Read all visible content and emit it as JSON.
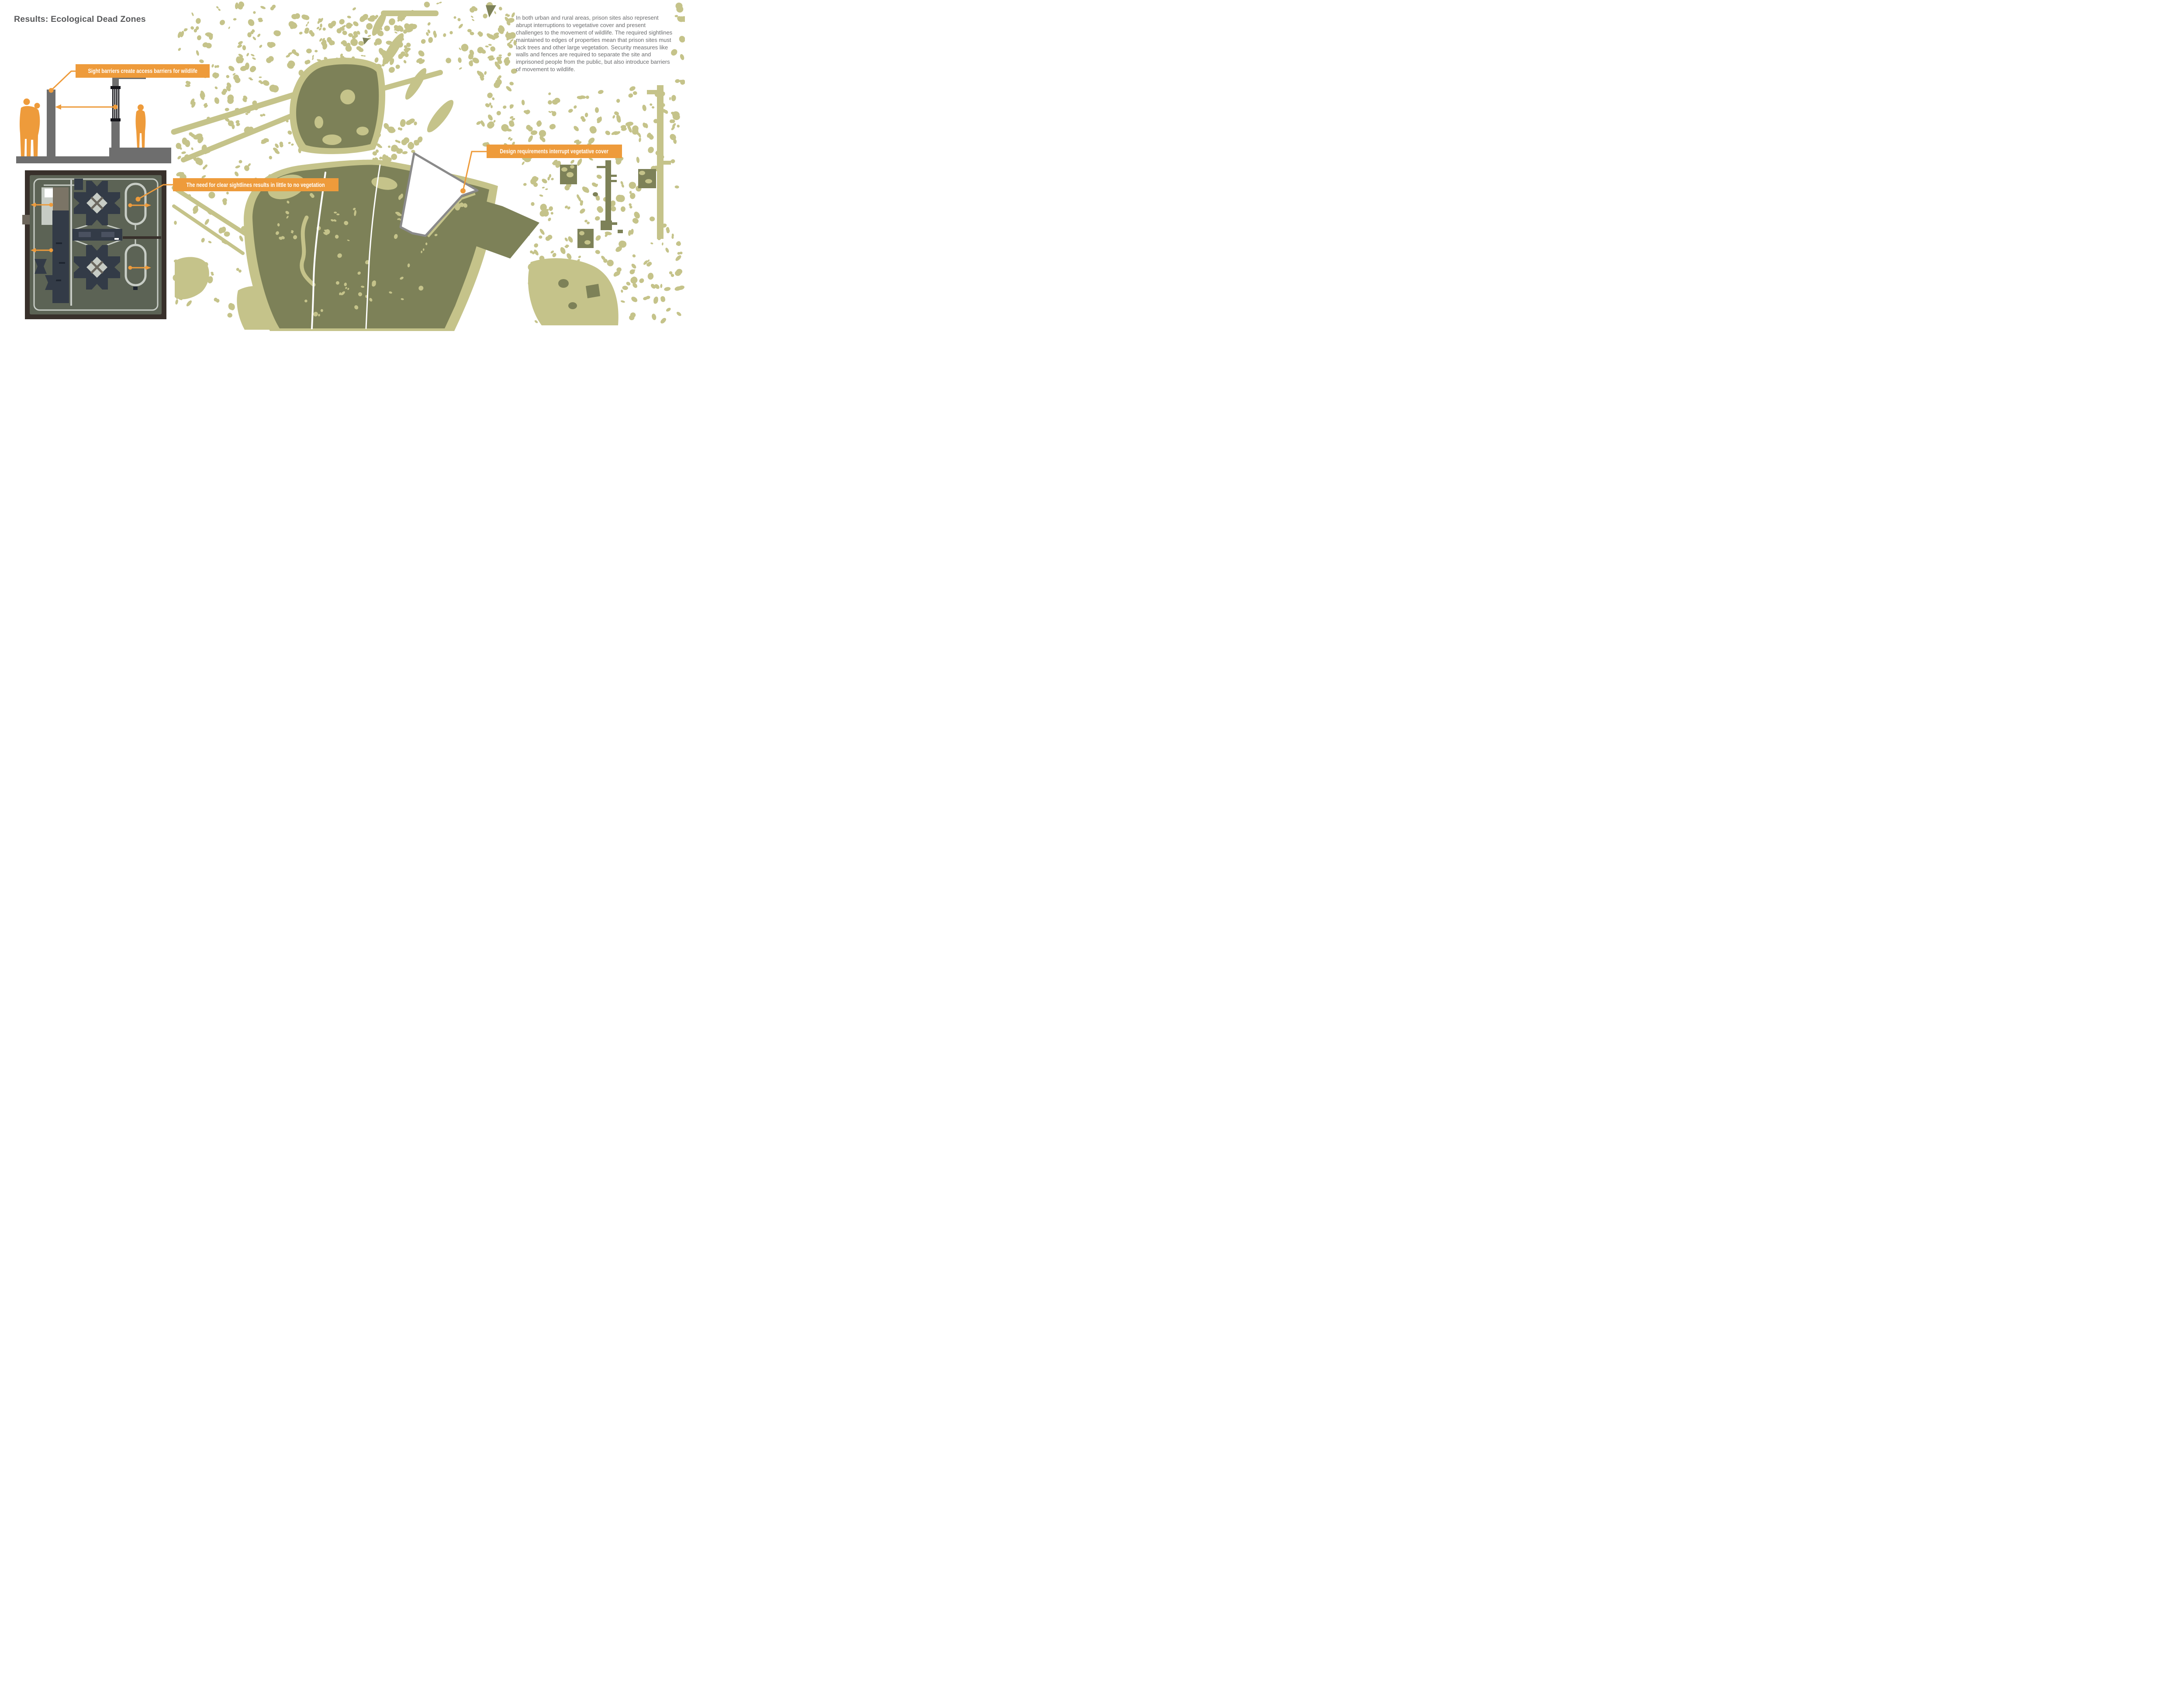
{
  "header": {
    "title": "Results: Ecological Dead Zones"
  },
  "description": {
    "text": "In both urban and rural areas, prison sites also represent abrupt interruptions to vegetative cover and present challenges to the movement of wildlife. The required sightlines maintained to edges of properties mean that prison sites must lack trees and other large vegetation. Security measures like walls and fences are required to separate the site and imprisoned people from the public, but also introduce barriers of movement to wildlife."
  },
  "callouts": [
    {
      "id": "sight-barriers",
      "label": "Sight barriers create access barriers for wildlife"
    },
    {
      "id": "clear-sightlines",
      "label": "The need for clear sightlines results in little to no vegetation"
    },
    {
      "id": "design-requirements",
      "label": "Design requirements interrupt vegetative cover"
    }
  ],
  "legend_semantics": {
    "light_vegetation": "scattered vegetative cover",
    "dark_vegetation": "dense vegetative cover / forest",
    "white_polygon": "prison site with vegetation removed"
  },
  "colors": {
    "orange": "#EE9B3B",
    "olive_light": "#C5C38A",
    "olive_dark": "#7D8158",
    "gray": "#6E6E6E",
    "ink": "#58595B",
    "body": "#6B6C6E",
    "plan_border": "#38302B",
    "plan_ground": "#5C6355",
    "plan_bldg": "#333B47",
    "plan_path": "#C7CCC5",
    "poly_stroke": "#8A8A8A"
  }
}
